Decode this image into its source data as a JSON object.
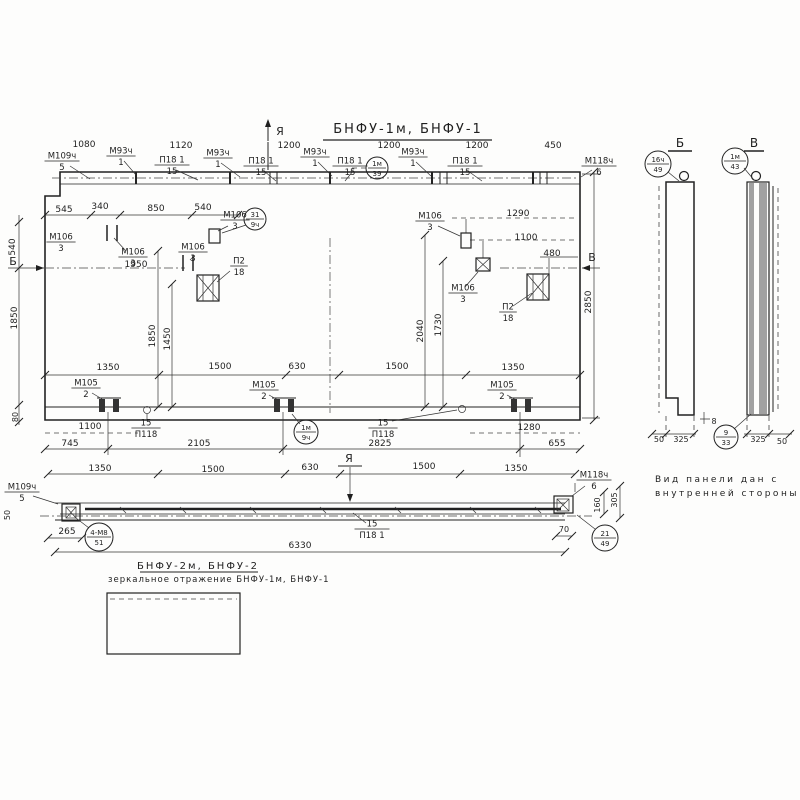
{
  "drawing": {
    "labels": [
      {
        "t": "Я",
        "x": 280,
        "y": 135,
        "s": 11,
        "n": "section-marker-ya-top"
      },
      {
        "t": "БНФУ-1м,  БНФУ-1",
        "x": 408,
        "y": 133,
        "s": 13,
        "sp": 2,
        "n": "drawing-title"
      },
      {
        "t": "1080",
        "x": 84,
        "y": 147
      },
      {
        "t": "1120",
        "x": 181,
        "y": 148
      },
      {
        "t": "1200",
        "x": 289,
        "y": 148
      },
      {
        "t": "1200",
        "x": 389,
        "y": 148
      },
      {
        "t": "1200",
        "x": 477,
        "y": 148
      },
      {
        "t": "450",
        "x": 553,
        "y": 148
      },
      {
        "t": "545",
        "x": 64,
        "y": 212
      },
      {
        "t": "340",
        "x": 100,
        "y": 209
      },
      {
        "t": "850",
        "x": 156,
        "y": 211
      },
      {
        "t": "540",
        "x": 203,
        "y": 210
      },
      {
        "t": "1950",
        "x": 136,
        "y": 267
      },
      {
        "t": "1290",
        "x": 518,
        "y": 216
      },
      {
        "t": "1100",
        "x": 526,
        "y": 240
      },
      {
        "t": "480",
        "x": 552,
        "y": 256
      },
      {
        "t": "1350",
        "x": 108,
        "y": 370
      },
      {
        "t": "1500",
        "x": 220,
        "y": 369
      },
      {
        "t": "630",
        "x": 297,
        "y": 369
      },
      {
        "t": "1500",
        "x": 397,
        "y": 369
      },
      {
        "t": "1350",
        "x": 513,
        "y": 370
      },
      {
        "t": "1100",
        "x": 90,
        "y": 429
      },
      {
        "t": "745",
        "x": 70,
        "y": 446
      },
      {
        "t": "2105",
        "x": 199,
        "y": 446
      },
      {
        "t": "2825",
        "x": 380,
        "y": 446
      },
      {
        "t": "1280",
        "x": 529,
        "y": 430
      },
      {
        "t": "655",
        "x": 557,
        "y": 446
      },
      {
        "t": "Б",
        "x": 13,
        "y": 265,
        "s": 11,
        "n": "section-arrow-b-label"
      },
      {
        "t": "В",
        "x": 592,
        "y": 261,
        "s": 11,
        "n": "section-arrow-v-label"
      },
      {
        "t": "540",
        "x": 15,
        "y": 247,
        "r": -90
      },
      {
        "t": "1850",
        "x": 17,
        "y": 318,
        "r": -90
      },
      {
        "t": "80",
        "x": 18,
        "y": 417,
        "r": -90,
        "s": 8
      },
      {
        "t": "1850",
        "x": 155,
        "y": 336,
        "r": -90
      },
      {
        "t": "1450",
        "x": 170,
        "y": 339,
        "r": -90
      },
      {
        "t": "2040",
        "x": 423,
        "y": 331,
        "r": -90
      },
      {
        "t": "1730",
        "x": 441,
        "y": 325,
        "r": -90
      },
      {
        "t": "2850",
        "x": 591,
        "y": 302,
        "r": -90
      },
      {
        "t": "1350",
        "x": 100,
        "y": 471
      },
      {
        "t": "1500",
        "x": 213,
        "y": 472
      },
      {
        "t": "630",
        "x": 310,
        "y": 470
      },
      {
        "t": "1500",
        "x": 424,
        "y": 469
      },
      {
        "t": "1350",
        "x": 516,
        "y": 471
      },
      {
        "t": "Я",
        "x": 349,
        "y": 462,
        "s": 11,
        "n": "section-marker-ya-plan"
      },
      {
        "t": "265",
        "x": 67,
        "y": 534
      },
      {
        "t": "50",
        "x": 10,
        "y": 515,
        "r": -90,
        "s": 8
      },
      {
        "t": "6330",
        "x": 300,
        "y": 548
      },
      {
        "t": "70",
        "x": 564,
        "y": 532,
        "s": 8
      },
      {
        "t": "160",
        "x": 600,
        "y": 505,
        "r": -90,
        "s": 8
      },
      {
        "t": "305",
        "x": 617,
        "y": 500,
        "r": -90,
        "s": 8
      },
      {
        "t": "Б",
        "x": 680,
        "y": 147,
        "s": 12,
        "n": "section-b-title"
      },
      {
        "t": "В",
        "x": 754,
        "y": 147,
        "s": 12,
        "n": "section-v-title"
      },
      {
        "t": "50",
        "x": 659,
        "y": 442,
        "s": 8
      },
      {
        "t": "325",
        "x": 681,
        "y": 442,
        "s": 8
      },
      {
        "t": "8",
        "x": 714,
        "y": 424,
        "s": 8
      },
      {
        "t": "325",
        "x": 758,
        "y": 442,
        "s": 8
      },
      {
        "t": "50",
        "x": 782,
        "y": 444,
        "s": 8
      },
      {
        "t": "Вид панели дан с",
        "x": 655,
        "y": 482,
        "a": "start",
        "sp": 2.5,
        "n": "view-note-line1"
      },
      {
        "t": "внутренней стороны",
        "x": 655,
        "y": 496,
        "a": "start",
        "sp": 2.5,
        "n": "view-note-line2"
      },
      {
        "t": "БНФУ-2м, БНФУ-2",
        "x": 198,
        "y": 569,
        "s": 10,
        "sp": 2,
        "n": "mirror-title"
      },
      {
        "t": "зеркальное отражение БНФУ-1м, БНФУ-1",
        "x": 108,
        "y": 582,
        "a": "start",
        "s": 8.5,
        "sp": 1,
        "n": "mirror-note"
      }
    ],
    "fractions": [
      {
        "top": "М109ч",
        "bot": "5",
        "x": 62,
        "y": 161
      },
      {
        "top": "М93ч",
        "bot": "1",
        "x": 121,
        "y": 156
      },
      {
        "top": "П18 1",
        "bot": "15",
        "x": 172,
        "y": 165
      },
      {
        "top": "М93ч",
        "bot": "1",
        "x": 218,
        "y": 158
      },
      {
        "top": "П18 1",
        "bot": "15",
        "x": 261,
        "y": 166
      },
      {
        "top": "М93ч",
        "bot": "1",
        "x": 315,
        "y": 157
      },
      {
        "top": "П18 1",
        "bot": "15",
        "x": 350,
        "y": 166
      },
      {
        "top": "М93ч",
        "bot": "1",
        "x": 413,
        "y": 157
      },
      {
        "top": "П18 1",
        "bot": "15",
        "x": 465,
        "y": 166
      },
      {
        "top": "М118ч",
        "bot": "6",
        "x": 599,
        "y": 166
      },
      {
        "top": "М106",
        "bot": "3",
        "x": 61,
        "y": 242
      },
      {
        "top": "М106",
        "bot": "3",
        "x": 133,
        "y": 257
      },
      {
        "top": "М106",
        "bot": "3",
        "x": 193,
        "y": 252
      },
      {
        "top": "М106",
        "bot": "3",
        "x": 235,
        "y": 220
      },
      {
        "top": "П2",
        "bot": "18",
        "x": 239,
        "y": 266
      },
      {
        "top": "М106",
        "bot": "3",
        "x": 430,
        "y": 221
      },
      {
        "top": "М106",
        "bot": "3",
        "x": 463,
        "y": 293
      },
      {
        "top": "П2",
        "bot": "18",
        "x": 508,
        "y": 312
      },
      {
        "top": "М105",
        "bot": "2",
        "x": 86,
        "y": 388
      },
      {
        "top": "М105",
        "bot": "2",
        "x": 264,
        "y": 390
      },
      {
        "top": "М105",
        "bot": "2",
        "x": 502,
        "y": 390
      },
      {
        "top": "15",
        "bot": "П118",
        "x": 146,
        "y": 428
      },
      {
        "top": "15",
        "bot": "П118",
        "x": 383,
        "y": 428
      },
      {
        "top": "М109ч",
        "bot": "5",
        "x": 22,
        "y": 492
      },
      {
        "top": "М118ч",
        "bot": "6",
        "x": 594,
        "y": 480
      },
      {
        "top": "15",
        "bot": "П18 1",
        "x": 372,
        "y": 529
      }
    ],
    "circles": [
      {
        "top": "1м",
        "bot": "39",
        "cx": 377,
        "cy": 168,
        "r": 11
      },
      {
        "top": "31",
        "bot": "9ч",
        "cx": 255,
        "cy": 219,
        "r": 11
      },
      {
        "top": "1м",
        "bot": "9ч",
        "cx": 306,
        "cy": 432,
        "r": 12
      },
      {
        "top": "4-М8",
        "bot": "51",
        "cx": 99,
        "cy": 537,
        "r": 14
      },
      {
        "top": "21",
        "bot": "49",
        "cx": 605,
        "cy": 538,
        "r": 13
      },
      {
        "top": "16ч",
        "bot": "49",
        "cx": 658,
        "cy": 164,
        "r": 13
      },
      {
        "top": "1м",
        "bot": "43",
        "cx": 735,
        "cy": 161,
        "r": 13
      },
      {
        "top": "9",
        "bot": "33",
        "cx": 726,
        "cy": 437,
        "r": 12
      }
    ]
  }
}
